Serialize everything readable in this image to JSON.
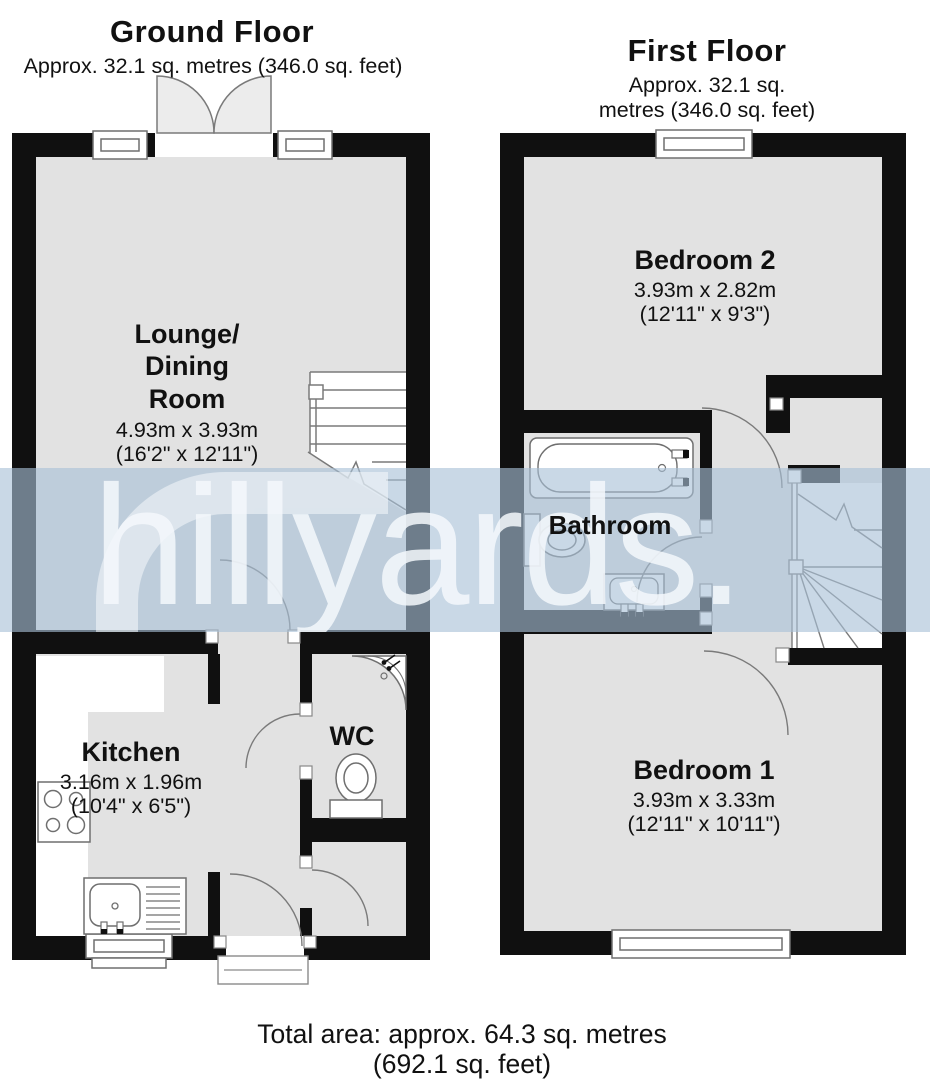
{
  "watermark": {
    "text": "hillyards."
  },
  "footer": {
    "total_area": "Total area: approx. 64.3 sq. metres (692.1 sq. feet)"
  },
  "ground_floor": {
    "title": "Ground Floor",
    "area_label": "Approx. 32.1 sq. metres (346.0 sq. feet)",
    "rooms": {
      "lounge": {
        "name": "Lounge/\nDining\nRoom",
        "dims_metric": "4.93m x 3.93m",
        "dims_imperial": "(16'2\" x 12'11\")"
      },
      "kitchen": {
        "name": "Kitchen",
        "dims_metric": "3.16m x 1.96m",
        "dims_imperial": "(10'4\" x 6'5\")"
      },
      "wc": {
        "name": "WC"
      }
    }
  },
  "first_floor": {
    "title": "First Floor",
    "area_label": "Approx. 32.1 sq. metres (346.0 sq. feet)",
    "rooms": {
      "bedroom2": {
        "name": "Bedroom 2",
        "dims_metric": "3.93m x 2.82m",
        "dims_imperial": "(12'11\" x 9'3\")"
      },
      "bathroom": {
        "name": "Bathroom"
      },
      "bedroom1": {
        "name": "Bedroom 1",
        "dims_metric": "3.93m x 3.33m",
        "dims_imperial": "(12'11\" x 10'11\")"
      }
    }
  },
  "colors": {
    "wall": "#101010",
    "floor": "#e2e2e2",
    "fixture_line": "#6f6f6f",
    "watermark_band": "#c9d6e2",
    "watermark_text": "#f2f6f9"
  }
}
